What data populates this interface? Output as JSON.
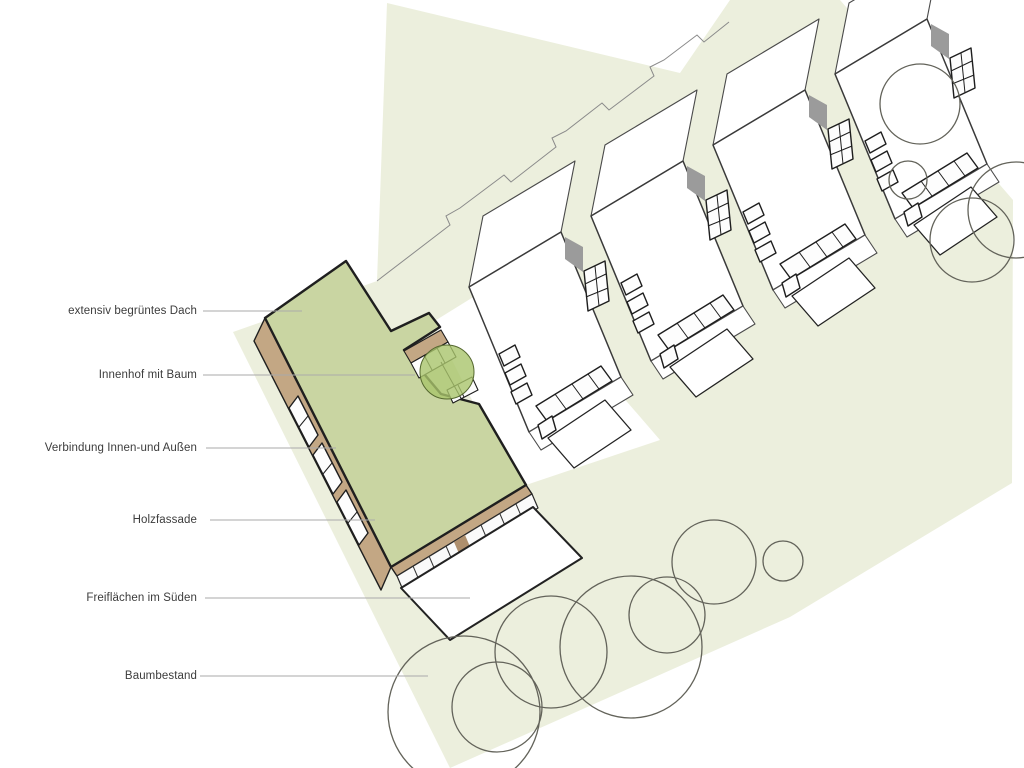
{
  "diagram": {
    "type": "architecture-axonometric-site-diagram",
    "labels": [
      {
        "text": "extensiv begrüntes Dach",
        "target": "green roof of main building"
      },
      {
        "text": "Innenhof mit Baum",
        "target": "courtyard with tree"
      },
      {
        "text": "Verbindung Innen-und Außen",
        "target": "window band of facade"
      },
      {
        "text": "Holzfassade",
        "target": "wooden facade"
      },
      {
        "text": "Freiflächen im Süden",
        "target": "open space terrace on south side"
      },
      {
        "text": "Baumbestand",
        "target": "existing tree circles"
      }
    ],
    "colors": {
      "site": "#ecefdd",
      "roof": "#c9d5a2",
      "wood": "#c3a784",
      "wood-dark": "#ae8f6d",
      "tree-fill": "#a9c46c",
      "shadow": "#9b9b9b",
      "outline": "#1f1f1f",
      "leader": "#aaaaaa",
      "label": "#3c3c3c",
      "house-stroke": "#4a4a4a"
    },
    "counts": {
      "rowhouses": 4,
      "existing_trees_top": 4,
      "existing_trees_bottom": 7,
      "courtyard_trees": 1
    }
  }
}
